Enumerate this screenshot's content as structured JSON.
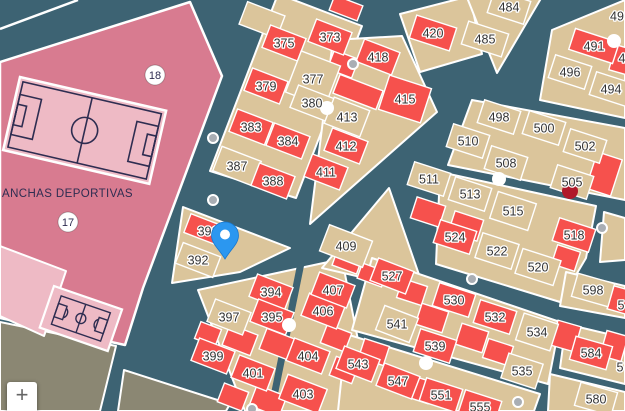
{
  "palette": {
    "street": "#3D6373",
    "parcel_red": "#F6514D",
    "parcel_tan": "#DBC59B",
    "block_pink": "#D87B90",
    "field_pink": "#EEBAC5",
    "navy_line": "#2E2D51",
    "olive": "#8B8773",
    "outline_white": "#FFFFFF",
    "label_text": "#333333",
    "dot_gray": "#A9AEB4",
    "poi_red": "#B0182B",
    "pin_blue": "#2B97F0"
  },
  "controls": {
    "zoom_in_label": "+"
  },
  "map": {
    "area_label": {
      "text": "ANCHAS DEPORTIVAS",
      "x": 2,
      "y": 197
    },
    "pill_labels": [
      {
        "text": "18",
        "x": 155,
        "y": 75
      },
      {
        "text": "17",
        "x": 68,
        "y": 222
      }
    ],
    "parcels": [
      {
        "label": "373",
        "x": 330,
        "y": 37,
        "color": "red"
      },
      {
        "label": "375",
        "x": 284,
        "y": 43,
        "color": "red"
      },
      {
        "label": "377",
        "x": 313,
        "y": 79,
        "color": "tan"
      },
      {
        "label": "379",
        "x": 266,
        "y": 86,
        "color": "red"
      },
      {
        "label": "380",
        "x": 312,
        "y": 103,
        "color": "tan"
      },
      {
        "label": "383",
        "x": 251,
        "y": 127,
        "color": "red"
      },
      {
        "label": "384",
        "x": 288,
        "y": 141,
        "color": "red"
      },
      {
        "label": "387",
        "x": 237,
        "y": 166,
        "color": "tan"
      },
      {
        "label": "388",
        "x": 273,
        "y": 181,
        "color": "red"
      },
      {
        "label": "391",
        "x": 208,
        "y": 231,
        "color": "red"
      },
      {
        "label": "392",
        "x": 198,
        "y": 260,
        "color": "tan"
      },
      {
        "label": "394",
        "x": 271,
        "y": 292,
        "color": "red"
      },
      {
        "label": "395",
        "x": 272,
        "y": 317,
        "color": "red"
      },
      {
        "label": "397",
        "x": 229,
        "y": 317,
        "color": "tan"
      },
      {
        "label": "399",
        "x": 213,
        "y": 356,
        "color": "red"
      },
      {
        "label": "401",
        "x": 253,
        "y": 373,
        "color": "red"
      },
      {
        "label": "403",
        "x": 303,
        "y": 394,
        "color": "red"
      },
      {
        "label": "404",
        "x": 308,
        "y": 356,
        "color": "red"
      },
      {
        "label": "406",
        "x": 323,
        "y": 311,
        "color": "red"
      },
      {
        "label": "407",
        "x": 333,
        "y": 290,
        "color": "red"
      },
      {
        "label": "409",
        "x": 346,
        "y": 246,
        "color": "tan"
      },
      {
        "label": "411",
        "x": 326,
        "y": 172,
        "color": "red"
      },
      {
        "label": "412",
        "x": 346,
        "y": 146,
        "color": "red"
      },
      {
        "label": "413",
        "x": 347,
        "y": 117,
        "color": "tan"
      },
      {
        "label": "415",
        "x": 405,
        "y": 99,
        "color": "red"
      },
      {
        "label": "418",
        "x": 378,
        "y": 57,
        "color": "red"
      },
      {
        "label": "420",
        "x": 433,
        "y": 33,
        "color": "red"
      },
      {
        "label": "484",
        "x": 509,
        "y": 7,
        "color": "tan"
      },
      {
        "label": "485",
        "x": 485,
        "y": 39,
        "color": "tan"
      },
      {
        "label": "491",
        "x": 594,
        "y": 46,
        "color": "red"
      },
      {
        "label": "494",
        "x": 611,
        "y": 89,
        "color": "tan"
      },
      {
        "label": "496",
        "x": 570,
        "y": 72,
        "color": "tan"
      },
      {
        "label": "498",
        "x": 499,
        "y": 117,
        "color": "tan"
      },
      {
        "label": "500",
        "x": 544,
        "y": 128,
        "color": "tan"
      },
      {
        "label": "502",
        "x": 585,
        "y": 146,
        "color": "tan"
      },
      {
        "label": "505",
        "x": 572,
        "y": 182,
        "color": "tan"
      },
      {
        "label": "508",
        "x": 506,
        "y": 163,
        "color": "tan"
      },
      {
        "label": "510",
        "x": 468,
        "y": 141,
        "color": "tan"
      },
      {
        "label": "511",
        "x": 429,
        "y": 179,
        "color": "tan"
      },
      {
        "label": "513",
        "x": 470,
        "y": 194,
        "color": "tan"
      },
      {
        "label": "515",
        "x": 513,
        "y": 211,
        "color": "tan"
      },
      {
        "label": "518",
        "x": 574,
        "y": 235,
        "color": "red"
      },
      {
        "label": "520",
        "x": 538,
        "y": 267,
        "color": "tan"
      },
      {
        "label": "522",
        "x": 497,
        "y": 251,
        "color": "tan"
      },
      {
        "label": "524",
        "x": 455,
        "y": 237,
        "color": "red"
      },
      {
        "label": "527",
        "x": 392,
        "y": 276,
        "color": "red"
      },
      {
        "label": "530",
        "x": 454,
        "y": 300,
        "color": "red"
      },
      {
        "label": "532",
        "x": 495,
        "y": 317,
        "color": "red"
      },
      {
        "label": "534",
        "x": 537,
        "y": 332,
        "color": "tan"
      },
      {
        "label": "535",
        "x": 522,
        "y": 371,
        "color": "tan"
      },
      {
        "label": "539",
        "x": 435,
        "y": 346,
        "color": "red"
      },
      {
        "label": "541",
        "x": 397,
        "y": 324,
        "color": "tan"
      },
      {
        "label": "543",
        "x": 358,
        "y": 364,
        "color": "red"
      },
      {
        "label": "547",
        "x": 398,
        "y": 381,
        "color": "red"
      },
      {
        "label": "551",
        "x": 441,
        "y": 395,
        "color": "red"
      },
      {
        "label": "555",
        "x": 480,
        "y": 407,
        "color": "red"
      },
      {
        "label": "580",
        "x": 596,
        "y": 399,
        "color": "tan"
      },
      {
        "label": "584",
        "x": 591,
        "y": 353,
        "color": "red"
      },
      {
        "label": "598",
        "x": 593,
        "y": 290,
        "color": "tan"
      }
    ],
    "label_fragments": [
      {
        "text": "49",
        "x": 617,
        "y": 16
      },
      {
        "text": "4",
        "x": 622,
        "y": 58
      },
      {
        "text": "5",
        "x": 621,
        "y": 305
      },
      {
        "text": "5",
        "x": 620,
        "y": 367
      }
    ],
    "markers": {
      "pin": {
        "x": 225,
        "y": 259
      },
      "poi_red_dot": {
        "x": 570,
        "y": 191
      },
      "junction_dots_white": [
        [
          327,
          108
        ],
        [
          614,
          41
        ],
        [
          499,
          179
        ],
        [
          289,
          325
        ],
        [
          426,
          363
        ]
      ],
      "junction_dots_gray": [
        [
          353,
          64
        ],
        [
          213,
          138
        ],
        [
          213,
          200
        ],
        [
          602,
          228
        ],
        [
          472,
          279
        ],
        [
          518,
          402
        ],
        [
          252,
          409
        ]
      ]
    }
  }
}
